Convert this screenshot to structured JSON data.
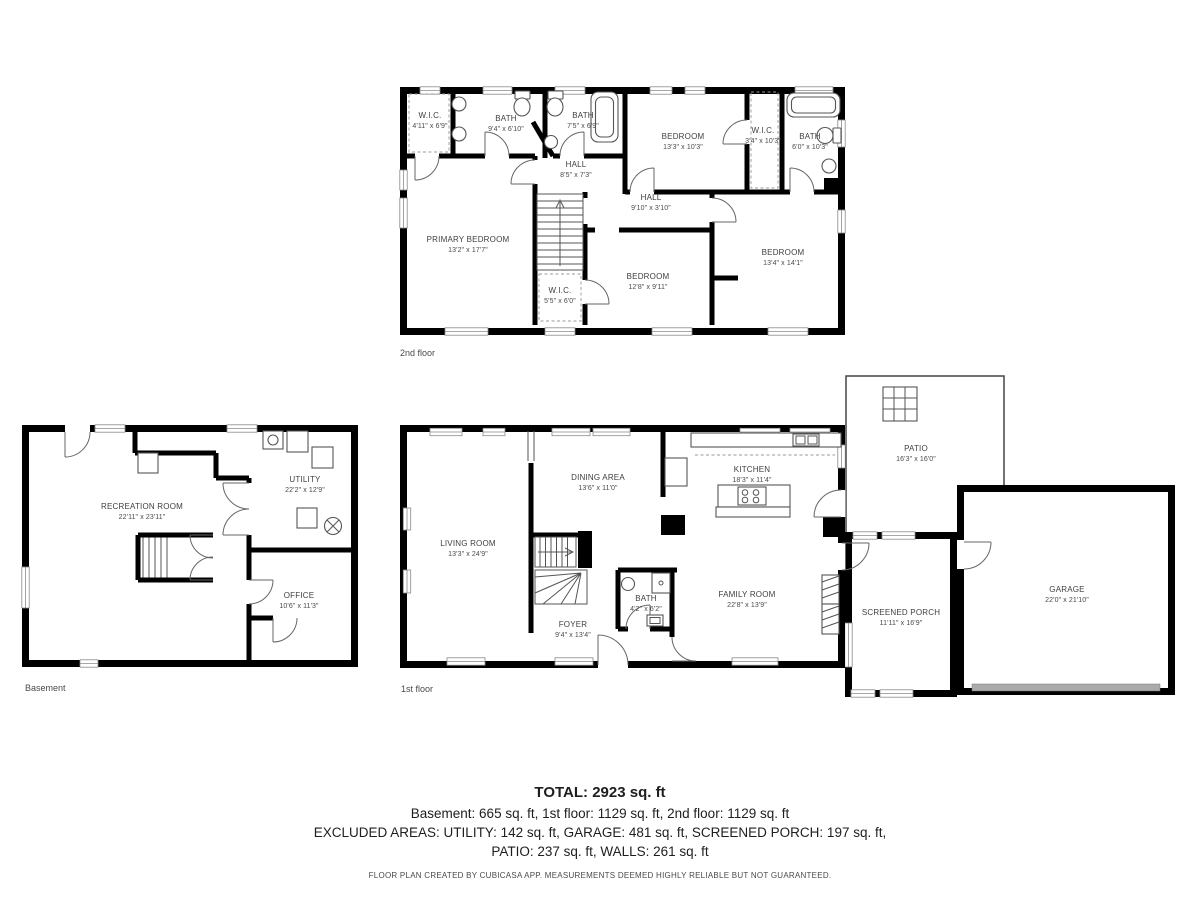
{
  "floors": {
    "second": {
      "label": "2nd floor",
      "rooms": [
        {
          "name": "W.I.C.",
          "dims": "4'11\" x 6'9\""
        },
        {
          "name": "BATH",
          "dims": "9'4\" x 6'10\""
        },
        {
          "name": "BATH",
          "dims": "7'5\" x 6'9\""
        },
        {
          "name": "HALL",
          "dims": "8'5\" x 7'3\""
        },
        {
          "name": "BEDROOM",
          "dims": "13'3\" x 10'3\""
        },
        {
          "name": "W.I.C.",
          "dims": "3'4\" x 10'3\""
        },
        {
          "name": "BATH",
          "dims": "6'0\" x 10'3\""
        },
        {
          "name": "HALL",
          "dims": "9'10\" x 3'10\""
        },
        {
          "name": "PRIMARY BEDROOM",
          "dims": "13'2\" x 17'7\""
        },
        {
          "name": "W.I.C.",
          "dims": "5'5\" x 6'0\""
        },
        {
          "name": "BEDROOM",
          "dims": "12'8\" x 9'11\""
        },
        {
          "name": "BEDROOM",
          "dims": "13'4\" x 14'1\""
        }
      ]
    },
    "basement": {
      "label": "Basement",
      "rooms": [
        {
          "name": "RECREATION ROOM",
          "dims": "22'11\" x 23'11\""
        },
        {
          "name": "UTILITY",
          "dims": "22'2\" x 12'9\""
        },
        {
          "name": "OFFICE",
          "dims": "10'6\" x 11'3\""
        }
      ]
    },
    "first": {
      "label": "1st floor",
      "rooms": [
        {
          "name": "LIVING ROOM",
          "dims": "13'3\" x 24'9\""
        },
        {
          "name": "DINING AREA",
          "dims": "13'6\" x 11'0\""
        },
        {
          "name": "KITCHEN",
          "dims": "18'3\" x 11'4\""
        },
        {
          "name": "FOYER",
          "dims": "9'4\" x 13'4\""
        },
        {
          "name": "BATH",
          "dims": "4'2\" x 6'2\""
        },
        {
          "name": "FAMILY ROOM",
          "dims": "22'8\" x 13'9\""
        },
        {
          "name": "PATIO",
          "dims": "16'3\" x 16'0\""
        },
        {
          "name": "SCREENED PORCH",
          "dims": "11'11\" x 16'9\""
        },
        {
          "name": "GARAGE",
          "dims": "22'0\" x 21'10\""
        }
      ]
    }
  },
  "summary": {
    "total": "TOTAL: 2923 sq. ft",
    "floors_line": "Basement: 665 sq. ft, 1st floor: 1129 sq. ft, 2nd floor: 1129 sq. ft",
    "excluded_line1": "EXCLUDED AREAS: UTILITY: 142 sq. ft, GARAGE: 481 sq. ft, SCREENED PORCH: 197 sq. ft,",
    "excluded_line2": "PATIO: 237 sq. ft, WALLS: 261 sq. ft",
    "disclaimer": "FLOOR PLAN CREATED BY CUBICASA APP. MEASUREMENTS DEEMED HIGHLY RELIABLE BUT NOT GUARANTEED."
  },
  "colors": {
    "wall": "#000000",
    "label": "#3f3f3f",
    "garage_door": "#aaaaaa"
  }
}
